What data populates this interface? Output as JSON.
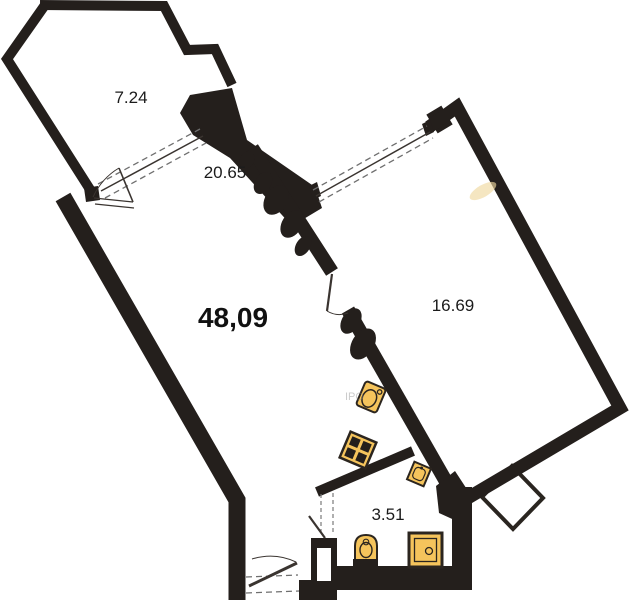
{
  "plan": {
    "type": "apartment-floor-plan",
    "total_area": "48,09",
    "rooms": [
      {
        "name": "balcony",
        "area": "7.24"
      },
      {
        "name": "living-room-kitchen",
        "area": "20.65"
      },
      {
        "name": "bedroom",
        "area": "16.69"
      },
      {
        "name": "bathroom",
        "area": "3.51"
      }
    ],
    "watermark": "IPO",
    "fixtures": [
      "kitchen-sink",
      "stove",
      "bathroom-sink",
      "toilet",
      "shower-tray"
    ],
    "colors": {
      "wall": "#241f1c",
      "fixture_fill": "#f5c45c",
      "fixture_stroke": "#2b251f",
      "background": "#ffffff"
    }
  }
}
